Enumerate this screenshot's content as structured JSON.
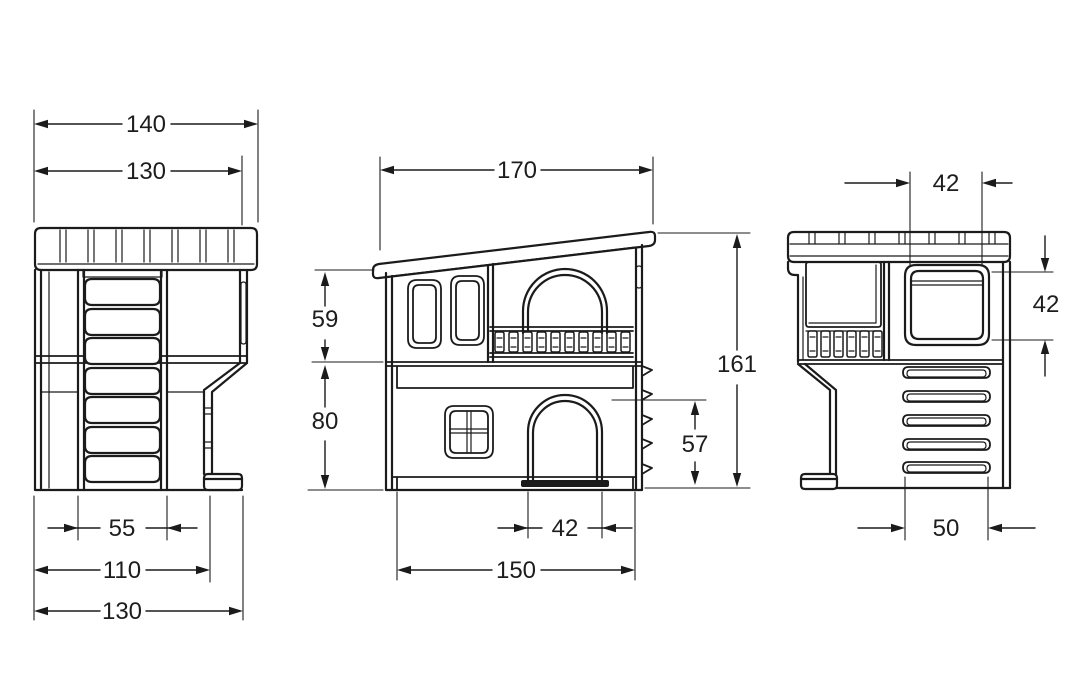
{
  "colors": {
    "line": "#1b1b1b",
    "background": "#ffffff"
  },
  "views": {
    "left_view": {
      "description": "left side view with ladder and crenellated top",
      "dims": {
        "top_outer": "140",
        "top_inner": "130",
        "ladder_width": "55",
        "base_inner": "110",
        "base_outer": "130"
      }
    },
    "front_view": {
      "description": "front view with sloped roof, two windows, balcony arch, four-pane window and arched door",
      "dims": {
        "roof_width": "170",
        "upper_floor_height": "59",
        "lower_floor_height": "80",
        "total_height": "161",
        "door_height": "57",
        "door_width": "42",
        "base_width": "150"
      }
    },
    "side_view": {
      "description": "right side view with square window, balcony opening and vent slots",
      "dims": {
        "window_width": "42",
        "window_height": "42",
        "vent_width": "50"
      }
    }
  }
}
